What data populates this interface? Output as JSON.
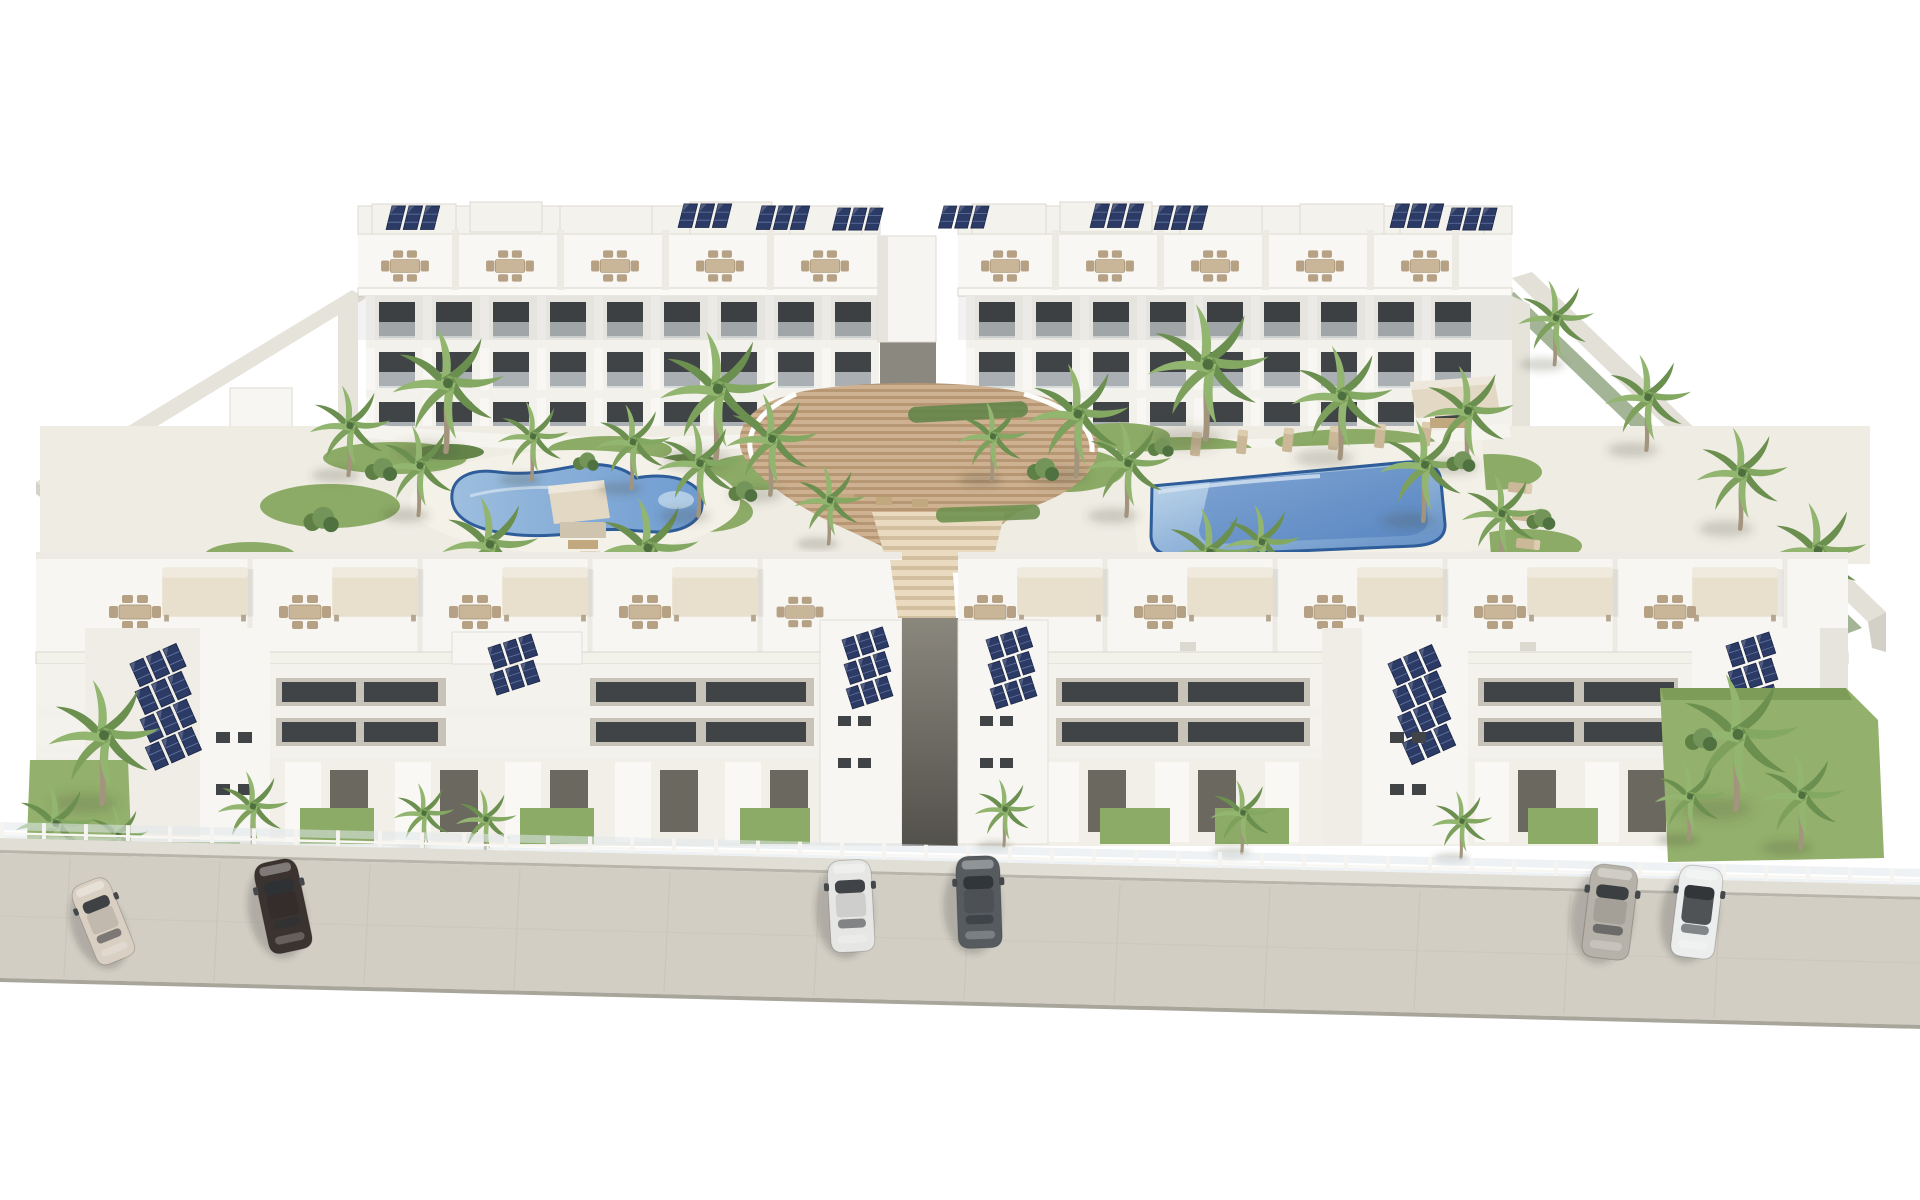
{
  "scene": {
    "description": "Aerial 3D architectural rendering of a white Mediterranean apartment complex: two rows of flat-roofed buildings with rooftop terraces, dining sets, cream parasols and dark-blue solar panel arrays; a landscaped inner courtyard with a kidney-shaped pool on the left, a rectangular pool on the right, palm trees and lawns; a wide cascading timber staircase on the central axis; private ground-floor gardens behind a glass fence; a beige street in front with six parked cars; pure white background.",
    "view": "high-angle aerial render",
    "background": "#ffffff"
  },
  "counts": {
    "building_blocks": 4,
    "swimming_pools": 2,
    "parked_cars": 6,
    "palm_trees": 39,
    "solar_panel_arrays": 15,
    "roof_dining_sets": 20
  },
  "palette": {
    "background": "#ffffff",
    "building_white": "#f7f6f2",
    "building_shade": "#e7e4dd",
    "wall_face": "#dfdcd4",
    "recess_gray": "#c7c3b9",
    "window_dark": "#404447",
    "glass_rail": "#ccd3d6",
    "solar_cell": "#2c3b66",
    "solar_frame": "#1c2747",
    "steps_light": "#cdb190",
    "steps_dark": "#b69673",
    "steps_pale": "#eadbc0",
    "steps_pale_dark": "#d2bf9f",
    "deck": "#efece4",
    "path_white": "#f6f4ee",
    "lawn": "#8cab66",
    "lawn_dark": "#64854a",
    "hedge": "#57793f",
    "palm_dark": "#6b8f4f",
    "palm_light": "#92b56f",
    "trunk": "#a3947e",
    "pool_rim": "#2f5d99",
    "pool_light": "#9dbede",
    "pool_mid": "#6e9bd1",
    "pool_shallow": "#c6dcee",
    "pool_deep": "#5e8cc4",
    "pergola_cream": "#e8dfcd",
    "furniture_tan": "#c9b597",
    "street": "#d2cec4",
    "street_edge": "#a8a59b",
    "sidewalk": "#e1ded6",
    "fence_glass": "#dfe7ea",
    "passage_dark": "#53514b",
    "shadow": "rgba(70,68,58,0.22)"
  },
  "pools": [
    {
      "name": "left pool",
      "shape": "kidney",
      "water_hex": "#6e9bd1"
    },
    {
      "name": "right pool",
      "shape": "rectangular",
      "water_hex": "#5e8cc4"
    }
  ],
  "cars": [
    {
      "name": "car 1",
      "color": "beige sedan",
      "hex": "#d9cfc2"
    },
    {
      "name": "car 2",
      "color": "dark brown sedan",
      "hex": "#3b3330"
    },
    {
      "name": "car 3",
      "color": "white sedan",
      "hex": "#e6e6e4"
    },
    {
      "name": "car 4",
      "color": "dark gray sedan",
      "hex": "#565b60"
    },
    {
      "name": "car 5",
      "color": "warm gray minivan",
      "hex": "#b7b2a9"
    },
    {
      "name": "car 6",
      "color": "white coupe with dark roof",
      "hex": "#eceded"
    }
  ]
}
